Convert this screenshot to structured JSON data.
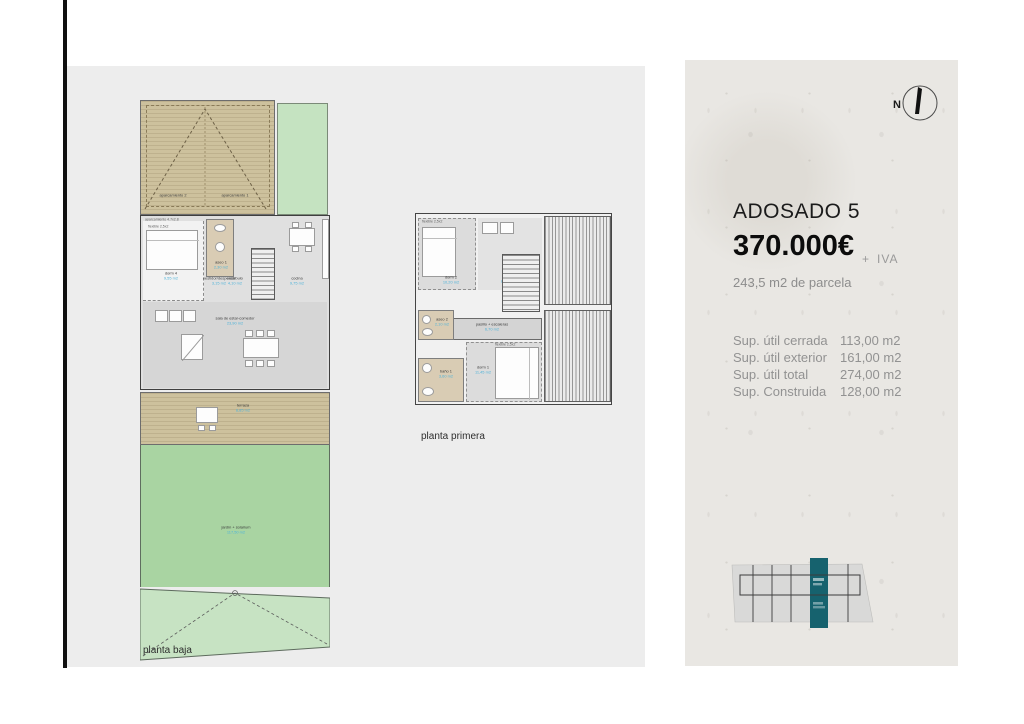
{
  "right_panel": {
    "title": "ADOSADO 5",
    "price": "370.000€",
    "price_plus": "+",
    "price_tax": "IVA",
    "parcel": "243,5 m2 de parcela",
    "compass_n": "N",
    "specs": [
      {
        "label": "Sup. útil cerrada",
        "value": "113,00 m2"
      },
      {
        "label": "Sup. útil exterior",
        "value": "161,00 m2"
      },
      {
        "label": "Sup. útil total",
        "value": "274,00 m2"
      },
      {
        "label": "Sup. Construida",
        "value": "128,00 m2"
      }
    ]
  },
  "plans": {
    "baja": {
      "caption": "planta baja",
      "parking_annotation": "aparcamiento 4.7x2.8",
      "bed_annotation": "flexible 2,5x2",
      "spot1": "aparcamiento 1",
      "spot2": "aparcamiento 2",
      "rooms": {
        "dorm4": {
          "label": "dorm 4",
          "area": "9,55 m2"
        },
        "aseo1": {
          "label": "aseo 1",
          "area": "2,30 m2"
        },
        "vestidor": {
          "label": "vestidor/despensa",
          "area": "3,15 m2"
        },
        "vestibulo": {
          "label": "vestíbulo",
          "area": "4,10 m2"
        },
        "cocina": {
          "label": "cocina",
          "area": "9,75 m2"
        },
        "sala": {
          "label": "sala de estar-comedor",
          "area": "23,90 m2"
        },
        "terraza": {
          "label": "terraza",
          "area": "8,85 m2"
        },
        "jardin": {
          "label": "jardín + solarium",
          "area": "117,50 m2"
        }
      }
    },
    "primera": {
      "caption": "planta primera",
      "bed_annotation": "flexible 2,5x2",
      "rooms": {
        "dorm2": {
          "label": "dorm 2",
          "area": "10,20 m2"
        },
        "dorm3": {
          "label": "dorm 3",
          "area": "8,35 m2"
        },
        "aseo2": {
          "label": "aseo 2",
          "area": "2,10 m2"
        },
        "bano1": {
          "label": "baño 1",
          "area": "3,60 m2"
        },
        "dorm1": {
          "label": "dorm 1",
          "area": "11,45 m2"
        },
        "pasillo": {
          "label": "pasillo + escaleras",
          "area": "6,70 m2"
        }
      }
    }
  },
  "colors": {
    "teal": "#16626e",
    "area_text_blue": "#4fb3d9",
    "parking_tan": "#cdc19d",
    "garden_green": "#a9d4a2",
    "pale_green": "#c5e3c1",
    "panel_bg": "#e9e7e3"
  }
}
